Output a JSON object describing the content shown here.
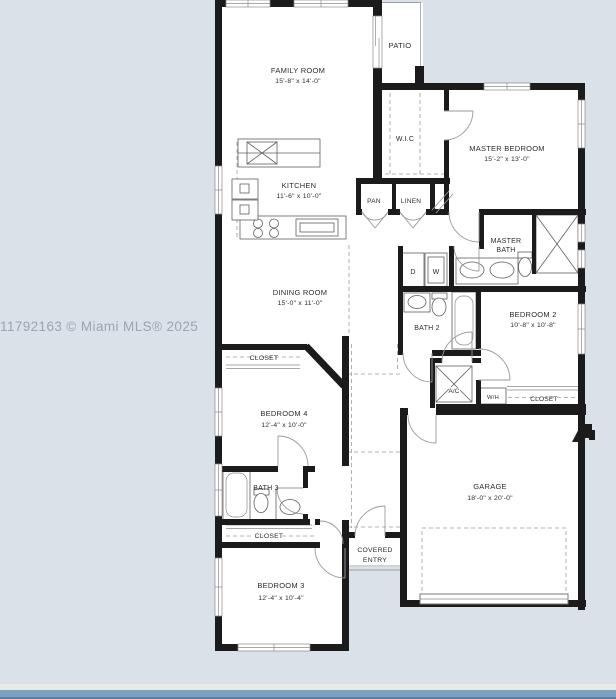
{
  "watermark": "11792163 © Miami MLS® 2025",
  "colors": {
    "page-bg": "#dae1e9",
    "wall": "#1b1b1b",
    "floor": "#ffffff",
    "label": "#2c2c2c",
    "watermark-color": "#9aa5ae",
    "bar-light": "#e7ebe3",
    "bar-mid": "#7ba1c1",
    "bar-dark": "#5d7f9d"
  },
  "rooms": {
    "family_room": {
      "label": "FAMILY ROOM",
      "dims": "15'-8\" x 14'-0\""
    },
    "patio": {
      "label": "PATIO"
    },
    "wic": {
      "label": "W.I.C"
    },
    "master_bedroom": {
      "label": "MASTER BEDROOM",
      "dims": "15'-2\" x 13'-0\""
    },
    "kitchen": {
      "label": "KITCHEN",
      "dims": "11'-6\" x 10'-0\""
    },
    "pantry": {
      "label": "PAN"
    },
    "linen": {
      "label": "LINEN"
    },
    "master_bath": {
      "line1": "MASTER",
      "line2": "BATH"
    },
    "dining_room": {
      "label": "DINING ROOM",
      "dims": "15'-0\" x 11'-0\""
    },
    "bath_2": {
      "label": "BATH 2"
    },
    "bedroom_2": {
      "label": "BEDROOM 2",
      "dims": "10'-8\" x 10'-8\""
    },
    "closet_bedroom4": {
      "label": "CLOSET"
    },
    "bedroom_4": {
      "label": "BEDROOM 4",
      "dims": "12'-4\" x 10'-0\""
    },
    "ac_closet": {
      "label": "A/C"
    },
    "water_heater": {
      "label": "W/H"
    },
    "closet_bedroom2": {
      "label": "CLOSET"
    },
    "garage": {
      "label": "GARAGE",
      "dims": "18'-0\" x 20'-0\""
    },
    "bath_3": {
      "label": "BATH 3"
    },
    "closet_bedroom3": {
      "label": "CLOSET"
    },
    "bedroom_3": {
      "label": "BEDROOM 3",
      "dims": "12'-4\" x 10'-4\""
    },
    "covered_entry": {
      "line1": "COVERED",
      "line2": "ENTRY"
    }
  },
  "laundry": {
    "dryer": "D",
    "washer": "W"
  }
}
